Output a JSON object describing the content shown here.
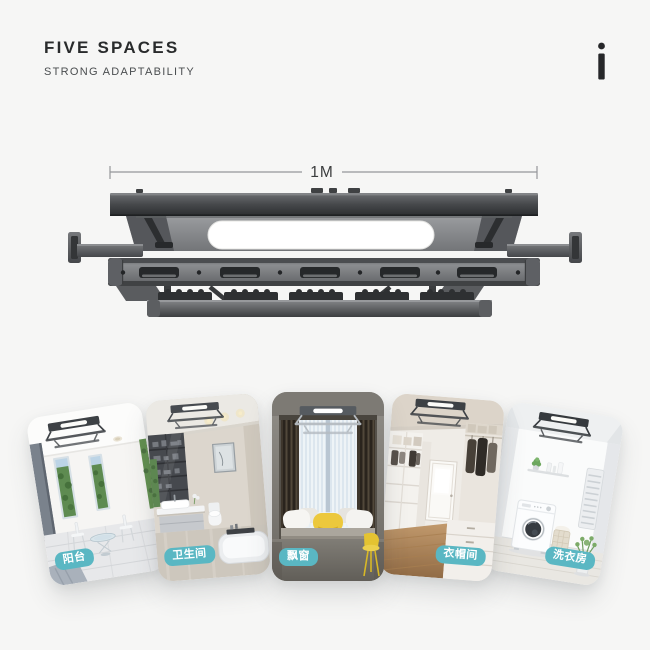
{
  "header": {
    "title": "FIVE SPACES",
    "subtitle": "STRONG ADAPTABILITY",
    "logo_glyph": "i"
  },
  "product": {
    "dimension_label": "1M"
  },
  "cards": [
    {
      "label": "阳台",
      "name": "balcony"
    },
    {
      "label": "卫生间",
      "name": "bathroom"
    },
    {
      "label": "飘窗",
      "name": "bay-window"
    },
    {
      "label": "衣帽间",
      "name": "cloakroom"
    },
    {
      "label": "洗衣房",
      "name": "laundry-room"
    }
  ],
  "colors": {
    "background": "#f6f6f5",
    "title_text": "#292b2c",
    "subtitle_text": "#4a4d4f",
    "badge_background": "#5ab7c3",
    "badge_text": "#ffffff",
    "product_dark": "#3a3c3e",
    "dimension_line": "#95979a"
  }
}
